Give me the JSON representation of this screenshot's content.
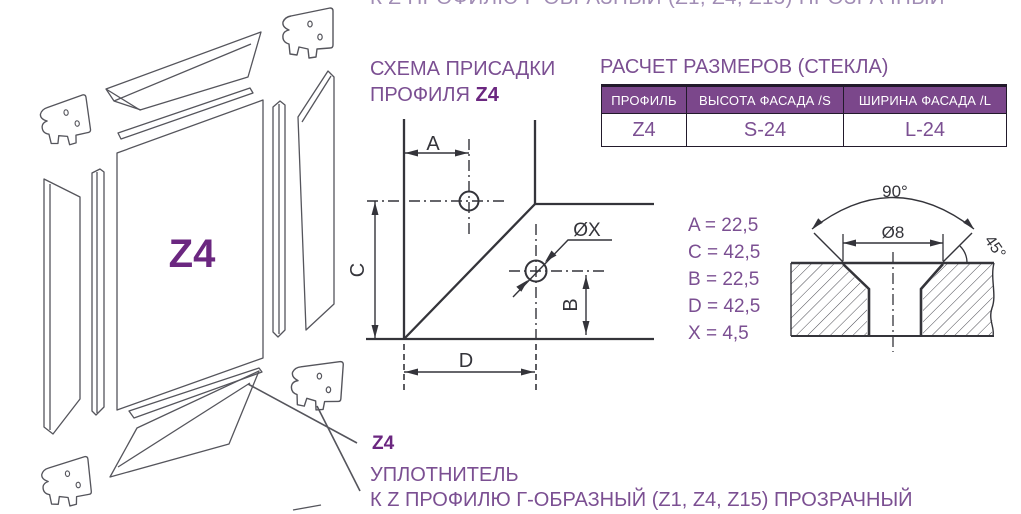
{
  "page": {
    "top_clipped_line": "К Z ПРОФИЛЮ Г-ОБРАЗНЫЙ (Z1, Z4, Z15) ПРОЗРАЧНЫЙ"
  },
  "exploded": {
    "panel_label": "Z4"
  },
  "scheme": {
    "title_line1": "СХЕМА ПРИСАДКИ",
    "title_line2": "ПРОФИЛЯ",
    "title_line2_code": "Z4",
    "dim_a": "A",
    "dim_b": "B",
    "dim_c": "C",
    "dim_d": "D",
    "dim_x": "ØX"
  },
  "glass_table": {
    "title": "РАСЧЕТ РАЗМЕРОВ (СТЕКЛА)",
    "headers": [
      "ПРОФИЛЬ",
      "ВЫСОТА ФАСАДА /S",
      "ШИРИНА ФАСАДА /L"
    ],
    "row": [
      "Z4",
      "S-24",
      "L-24"
    ]
  },
  "dimensions": {
    "a": "A = 22,5",
    "c": "C = 42,5",
    "b": "B = 22,5",
    "d": "D = 42,5",
    "x": "X = 4,5"
  },
  "countersink": {
    "top_angle": "90°",
    "diameter": "Ø8",
    "side_angle": "45°"
  },
  "product": {
    "code": "Z4",
    "name": "УПЛОТНИТЕЛЬ",
    "description": "К Z ПРОФИЛЮ Г-ОБРАЗНЫЙ (Z1, Z4, Z15) ПРОЗРАЧНЫЙ"
  },
  "colors": {
    "purple": "#7B4F92",
    "purple_dark": "#6B2780",
    "table_header_bg": "#7B478B",
    "table_border": "#221A2B",
    "drawing_line": "#34343A",
    "exploded_line": "#55555C"
  }
}
